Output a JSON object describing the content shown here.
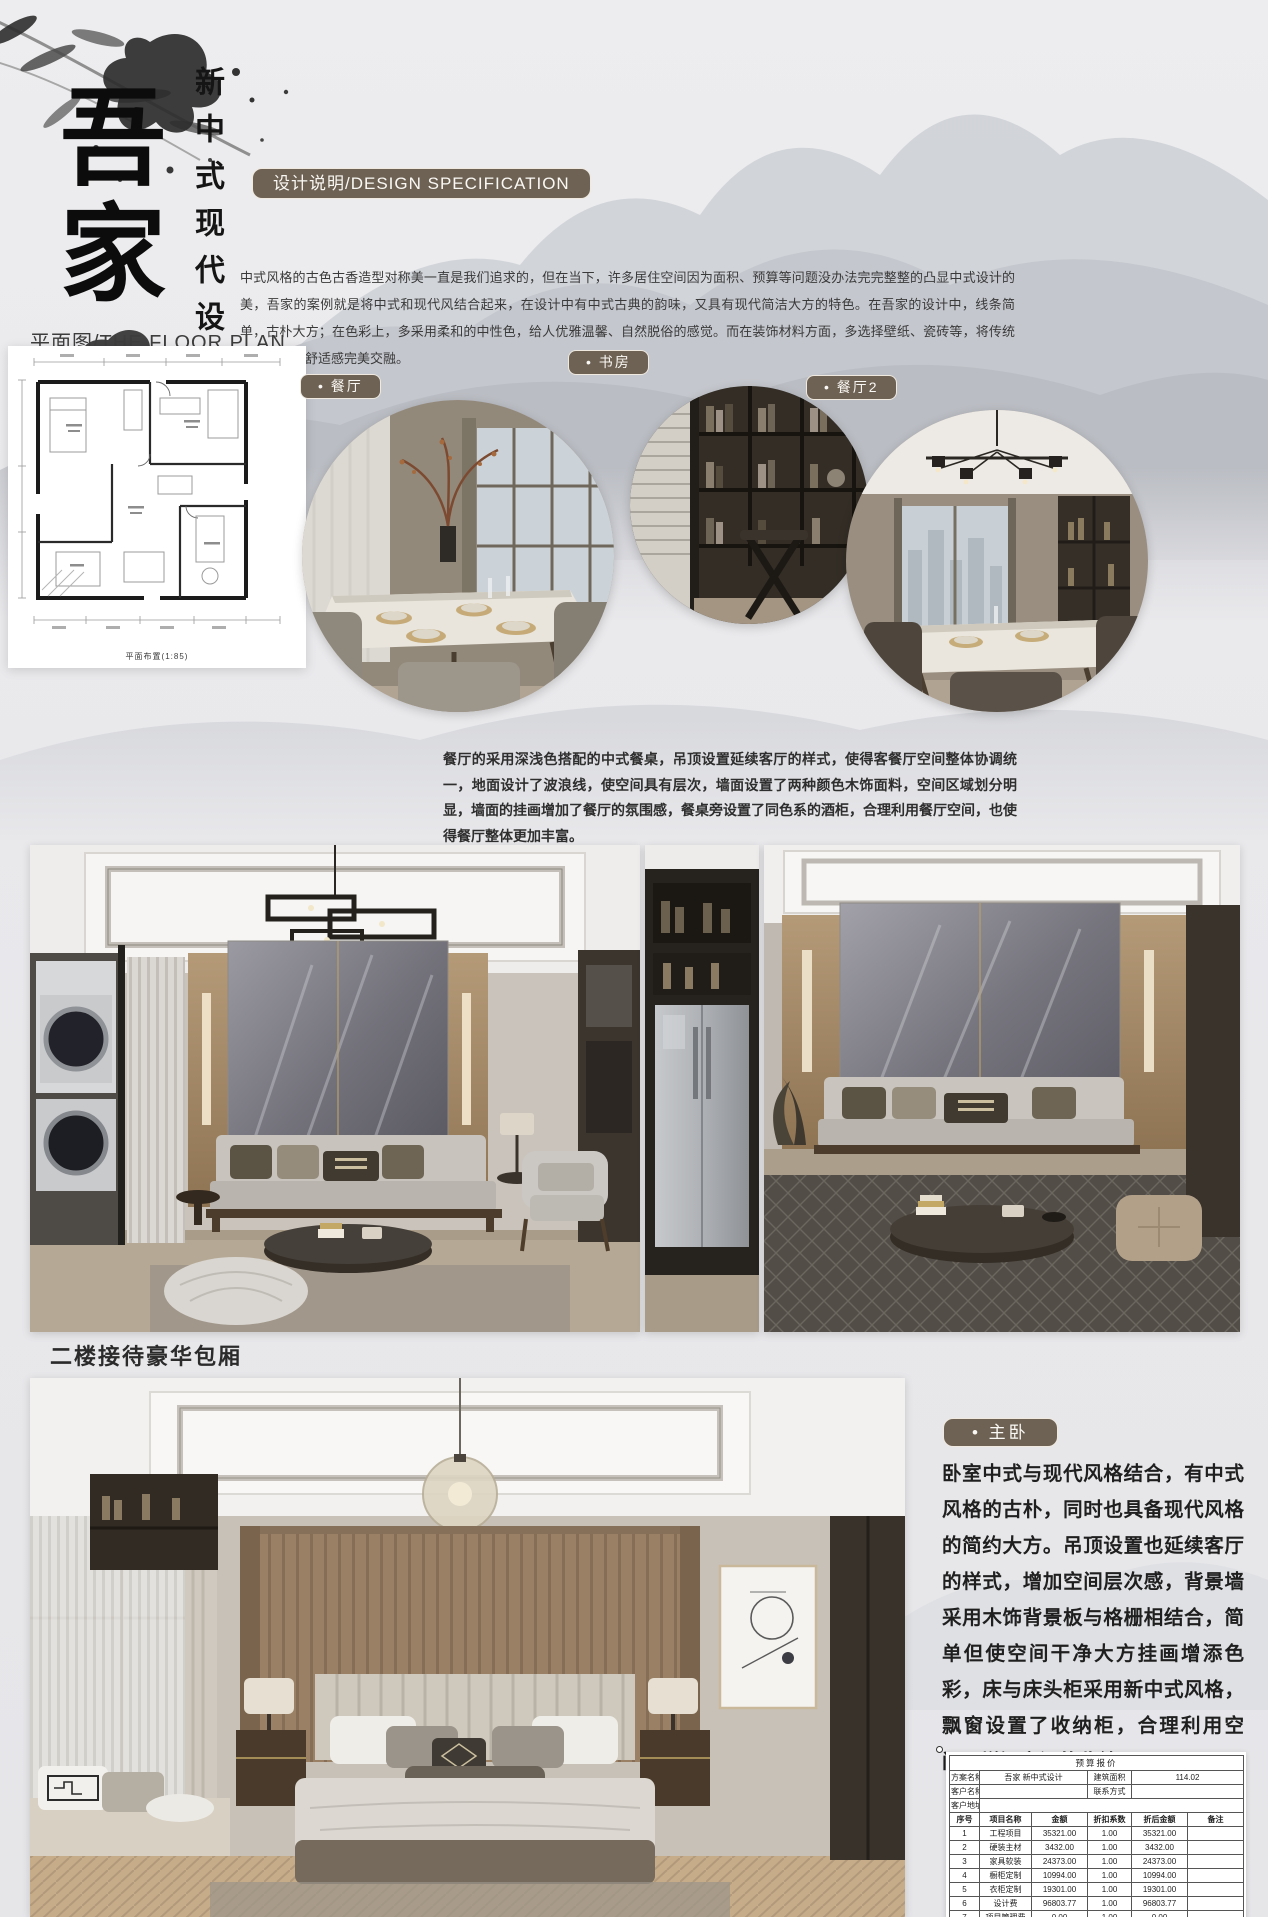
{
  "header": {
    "title_vertical": "吾家",
    "subtitle_vertical": "新中式现代设计"
  },
  "design_spec": {
    "badge_label": "设计说明/DESIGN SPECIFICATION",
    "body": "中式风格的古色古香造型对称美一直是我们追求的，但在当下，许多居住空间因为面积、预算等问题没办法完完整整的凸显中式设计的美，吾家的案例就是将中式和现代风结合起来，在设计中有中式古典的韵味，又具有现代简洁大方的特色。在吾家的设计中，线条简单，古朴大方；在色彩上，多采用柔和的中性色，给人优雅温馨、自然脱俗的感觉。而在装饰材料方面，多选择壁纸、瓷砖等，将传统风韵与现代舒适感完美交融。"
  },
  "floor_plan": {
    "section_label": "平面图/THE FLOOR PLAN",
    "caption": "平面布置(1:85)"
  },
  "photo_circles": [
    {
      "label": "• 餐厅"
    },
    {
      "label": "• 书房"
    },
    {
      "label": "• 餐厅2"
    }
  ],
  "dining_paragraph": "餐厅的采用深浅色搭配的中式餐桌，吊顶设置延续客厅的样式，使得客餐厅空间整体协调统一，地面设计了波浪线，使空间具有层次，墙面设置了两种颜色木饰面料，空间区域划分明显，墙面的挂画增加了餐厅的氛围感，餐桌旁设置了同色系的酒柜，合理利用餐厅空间，也使得餐厅整体更加丰富。",
  "second_floor_label": "二楼接待豪华包厢",
  "master_bedroom": {
    "badge_label": "• 主卧",
    "body": "卧室中式与现代风格结合，有中式风格的古朴，同时也具备现代风格的简约大方。吊顶设置也延续客厅的样式，增加空间层次感，背景墙采用木饰背景板与格栅相结合，简单但使空间干净大方挂画增添色彩，床与床头柜采用新中式风格，飘窗设置了收纳柜，合理利用空间，增添空间的收纳"
  },
  "budget_table": {
    "title": "预算报价",
    "meta_rows": [
      {
        "label1": "方案名称",
        "value1": "吾家 新中式设计",
        "label2": "建筑面积",
        "value2": "114.02"
      },
      {
        "label1": "客户名称",
        "value1": "",
        "label2": "联系方式",
        "value2": ""
      },
      {
        "label1": "客户地址",
        "value1": "",
        "label2": "",
        "value2": ""
      }
    ],
    "columns": [
      "序号",
      "项目名称",
      "金额",
      "折扣系数",
      "折后金额",
      "备注"
    ],
    "rows": [
      [
        "1",
        "工程项目",
        "35321.00",
        "1.00",
        "35321.00",
        ""
      ],
      [
        "2",
        "硬装主材",
        "3432.00",
        "1.00",
        "3432.00",
        ""
      ],
      [
        "3",
        "家具软装",
        "24373.00",
        "1.00",
        "24373.00",
        ""
      ],
      [
        "4",
        "橱柜定制",
        "10994.00",
        "1.00",
        "10994.00",
        ""
      ],
      [
        "5",
        "衣柜定制",
        "19301.00",
        "1.00",
        "19301.00",
        ""
      ],
      [
        "6",
        "设计费",
        "96803.77",
        "1.00",
        "96803.77",
        ""
      ],
      [
        "7",
        "项目管理费",
        "0.00",
        "1.00",
        "0.00",
        ""
      ],
      [
        "8",
        "税金",
        "3301.01",
        "1.00",
        "3301.01",
        ""
      ]
    ],
    "total_label": "总计",
    "total_value": "193525.78",
    "footer": "报价说明"
  },
  "colors": {
    "badge_brown": "#6e6254",
    "text_dark": "#2f2f2f",
    "background": "#e9e9ec"
  }
}
